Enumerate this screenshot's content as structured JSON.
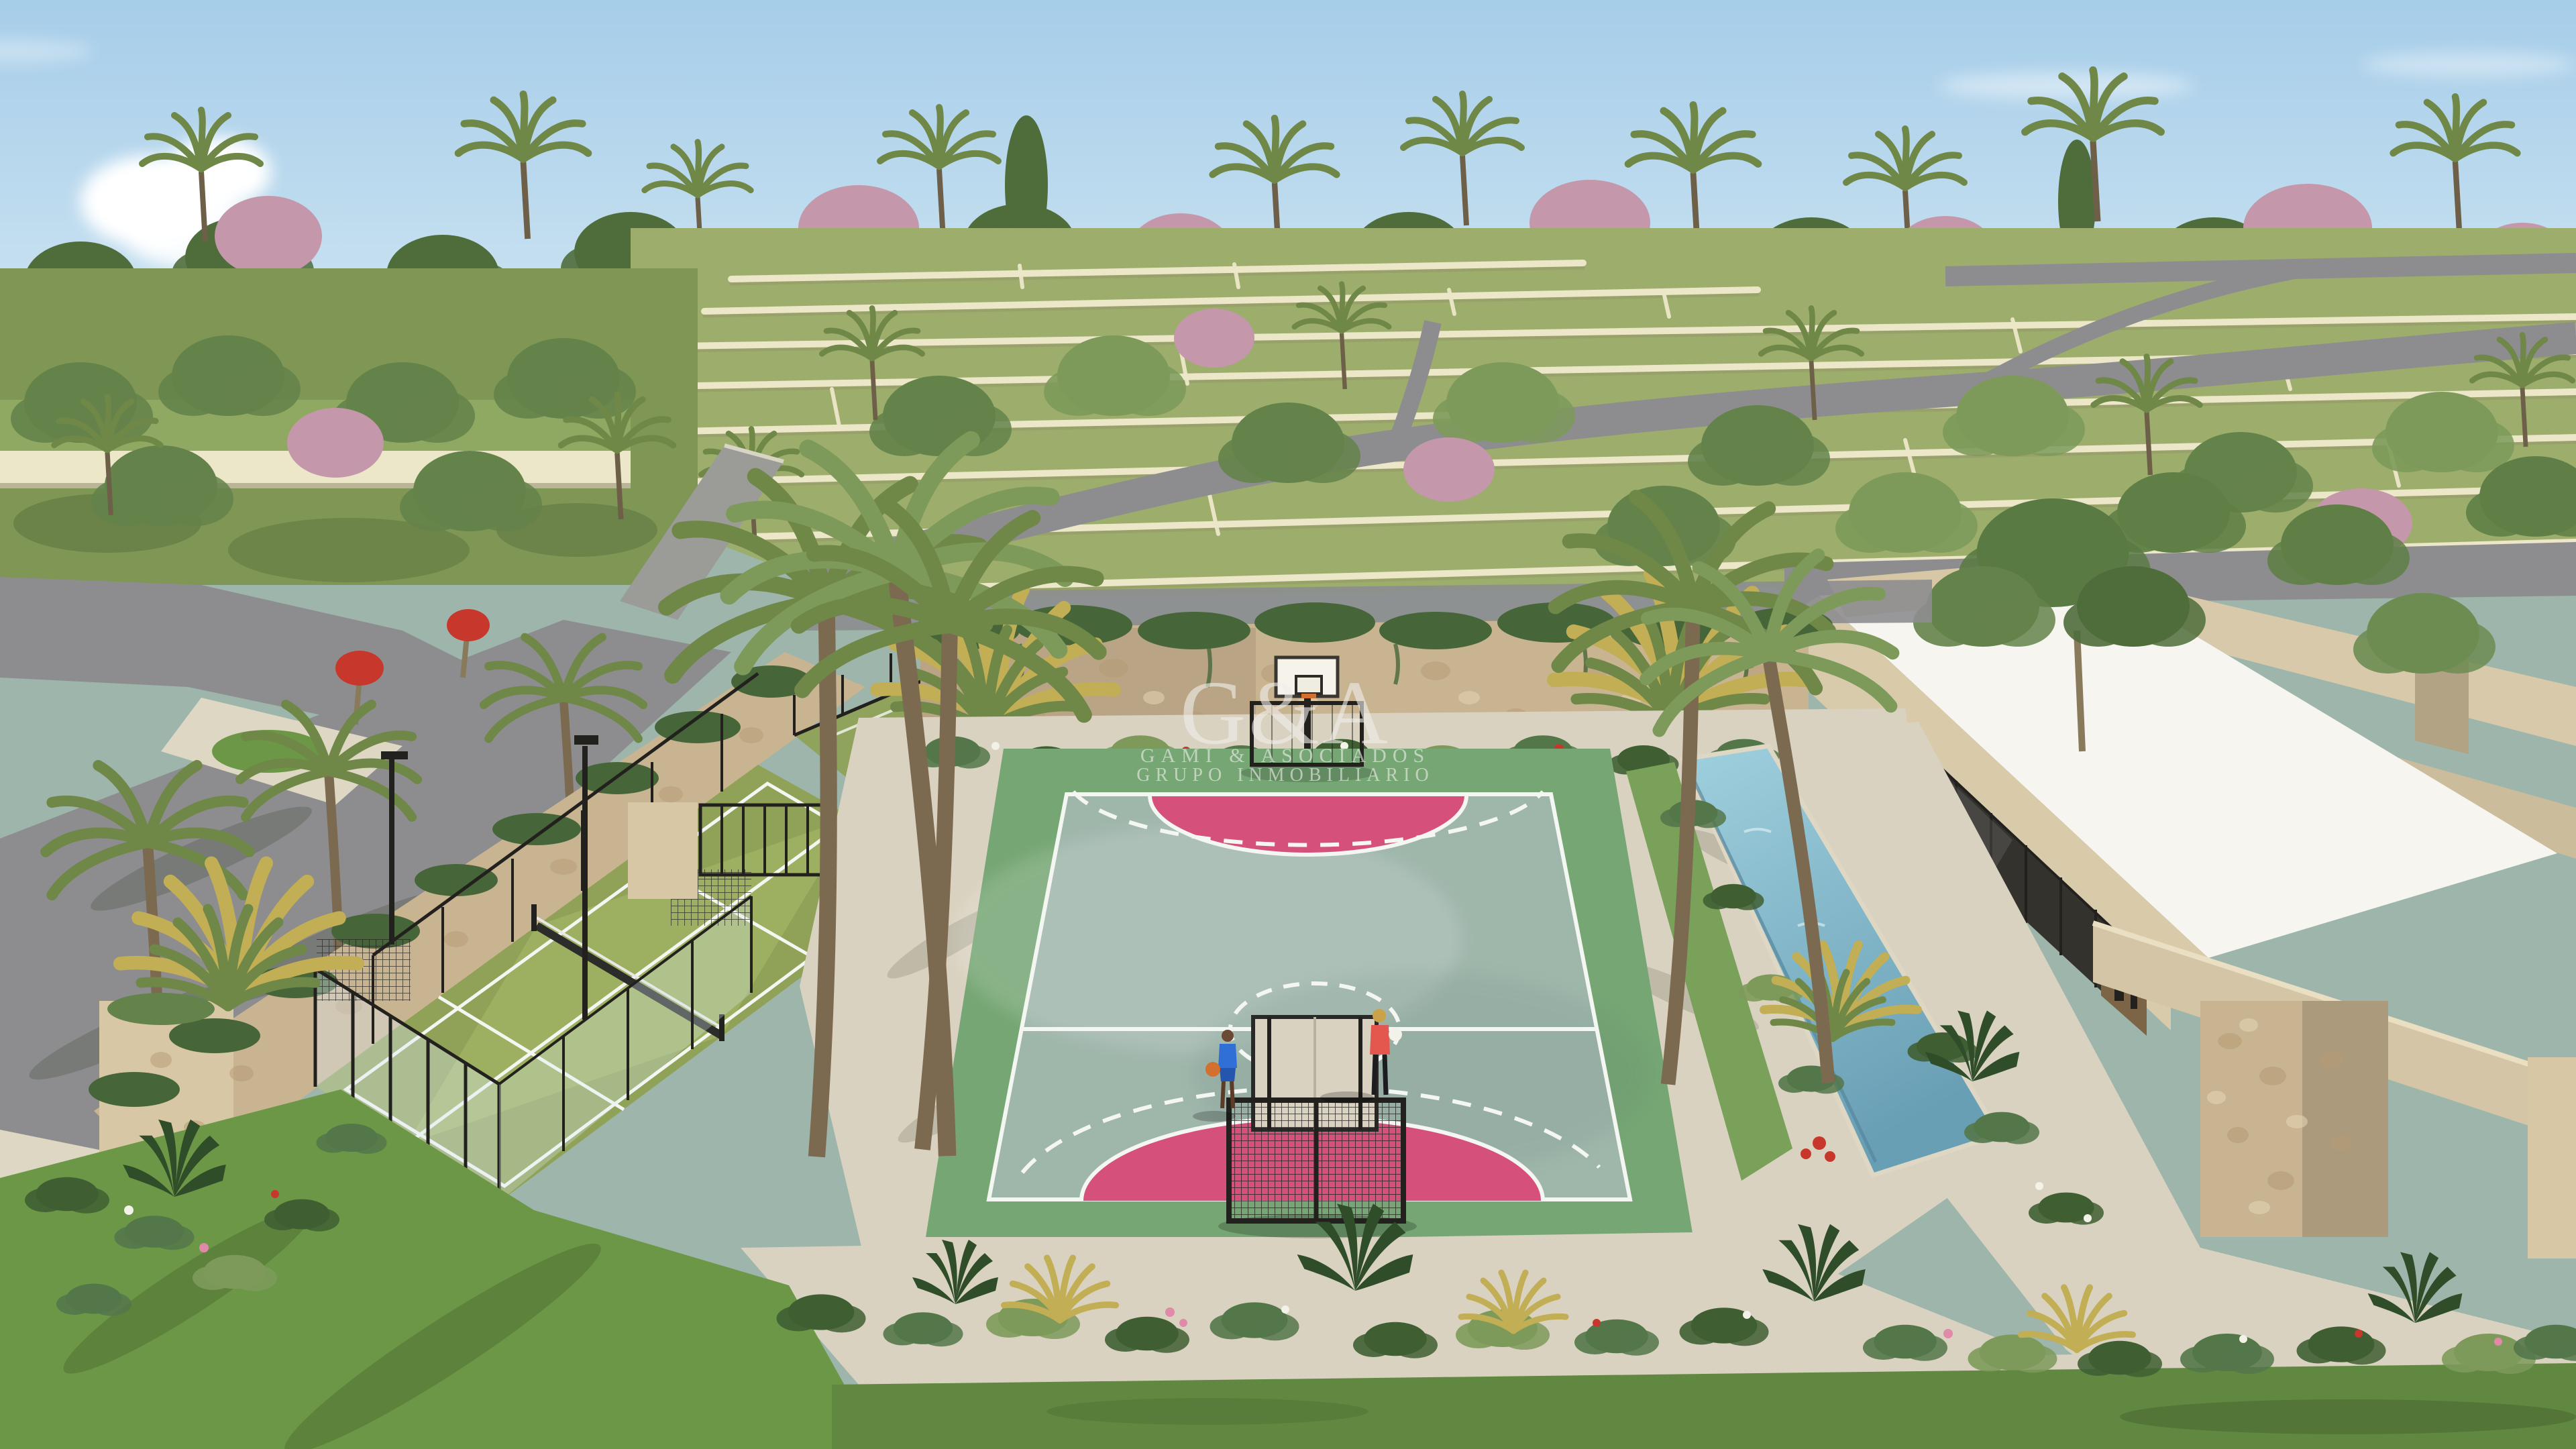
{
  "watermark": {
    "monogram": "G&A",
    "company_line": "GAMI & ASOCIADOS",
    "tagline_line": "GRUPO INMOBILIARIO"
  },
  "palette": {
    "sky_top": "#a6cde9",
    "sky_horizon": "#d4e8f3",
    "cloud": "#ffffff",
    "canopy_dark": "#4f6d3b",
    "canopy_mid": "#64834a",
    "canopy_light": "#7d9a5a",
    "canopy_olive": "#6f8747",
    "bloom_pink": "#c497ab",
    "lot_grass": "#9cad6c",
    "garden_green": "#7f9655",
    "terrace_wall": "#ece7c9",
    "road": "#8d8d8f",
    "sidewalk": "#ddd7c3",
    "stone": "#c9b491",
    "stone_light": "#d8c7a4",
    "ivy": "#46663a",
    "padel_turf": "#8fa258",
    "padel_turf_lit": "#a9bb6a",
    "court_surface": "#9fb6ab",
    "court_apron": "#76a674",
    "court_pink": "#d5507a",
    "court_line": "#f4f6f2",
    "sand": "#dad2c0",
    "lawn": "#618841",
    "lawn_bright": "#6c9747",
    "roof_white": "#f7f5ef",
    "building_wall": "#d8cbab",
    "building_glass": "#34322d",
    "building_interior": "#7c6547",
    "pool_top": "#9fd0de",
    "pool_deep": "#699fb5",
    "frame_dark": "#23211e",
    "shrub_dark": "#3f5f33",
    "shrub_mid": "#54774a",
    "flower_red": "#c8372b",
    "flower_white": "#f2f2e8",
    "flower_pink": "#e089a8",
    "trunk": "#8a7a5c",
    "palm_gold": "#c2ae54",
    "person_blue": "#2f6fd6",
    "person_coral": "#e4574e",
    "ball_orange": "#d2702f",
    "watermark_color": "#efeeea"
  }
}
